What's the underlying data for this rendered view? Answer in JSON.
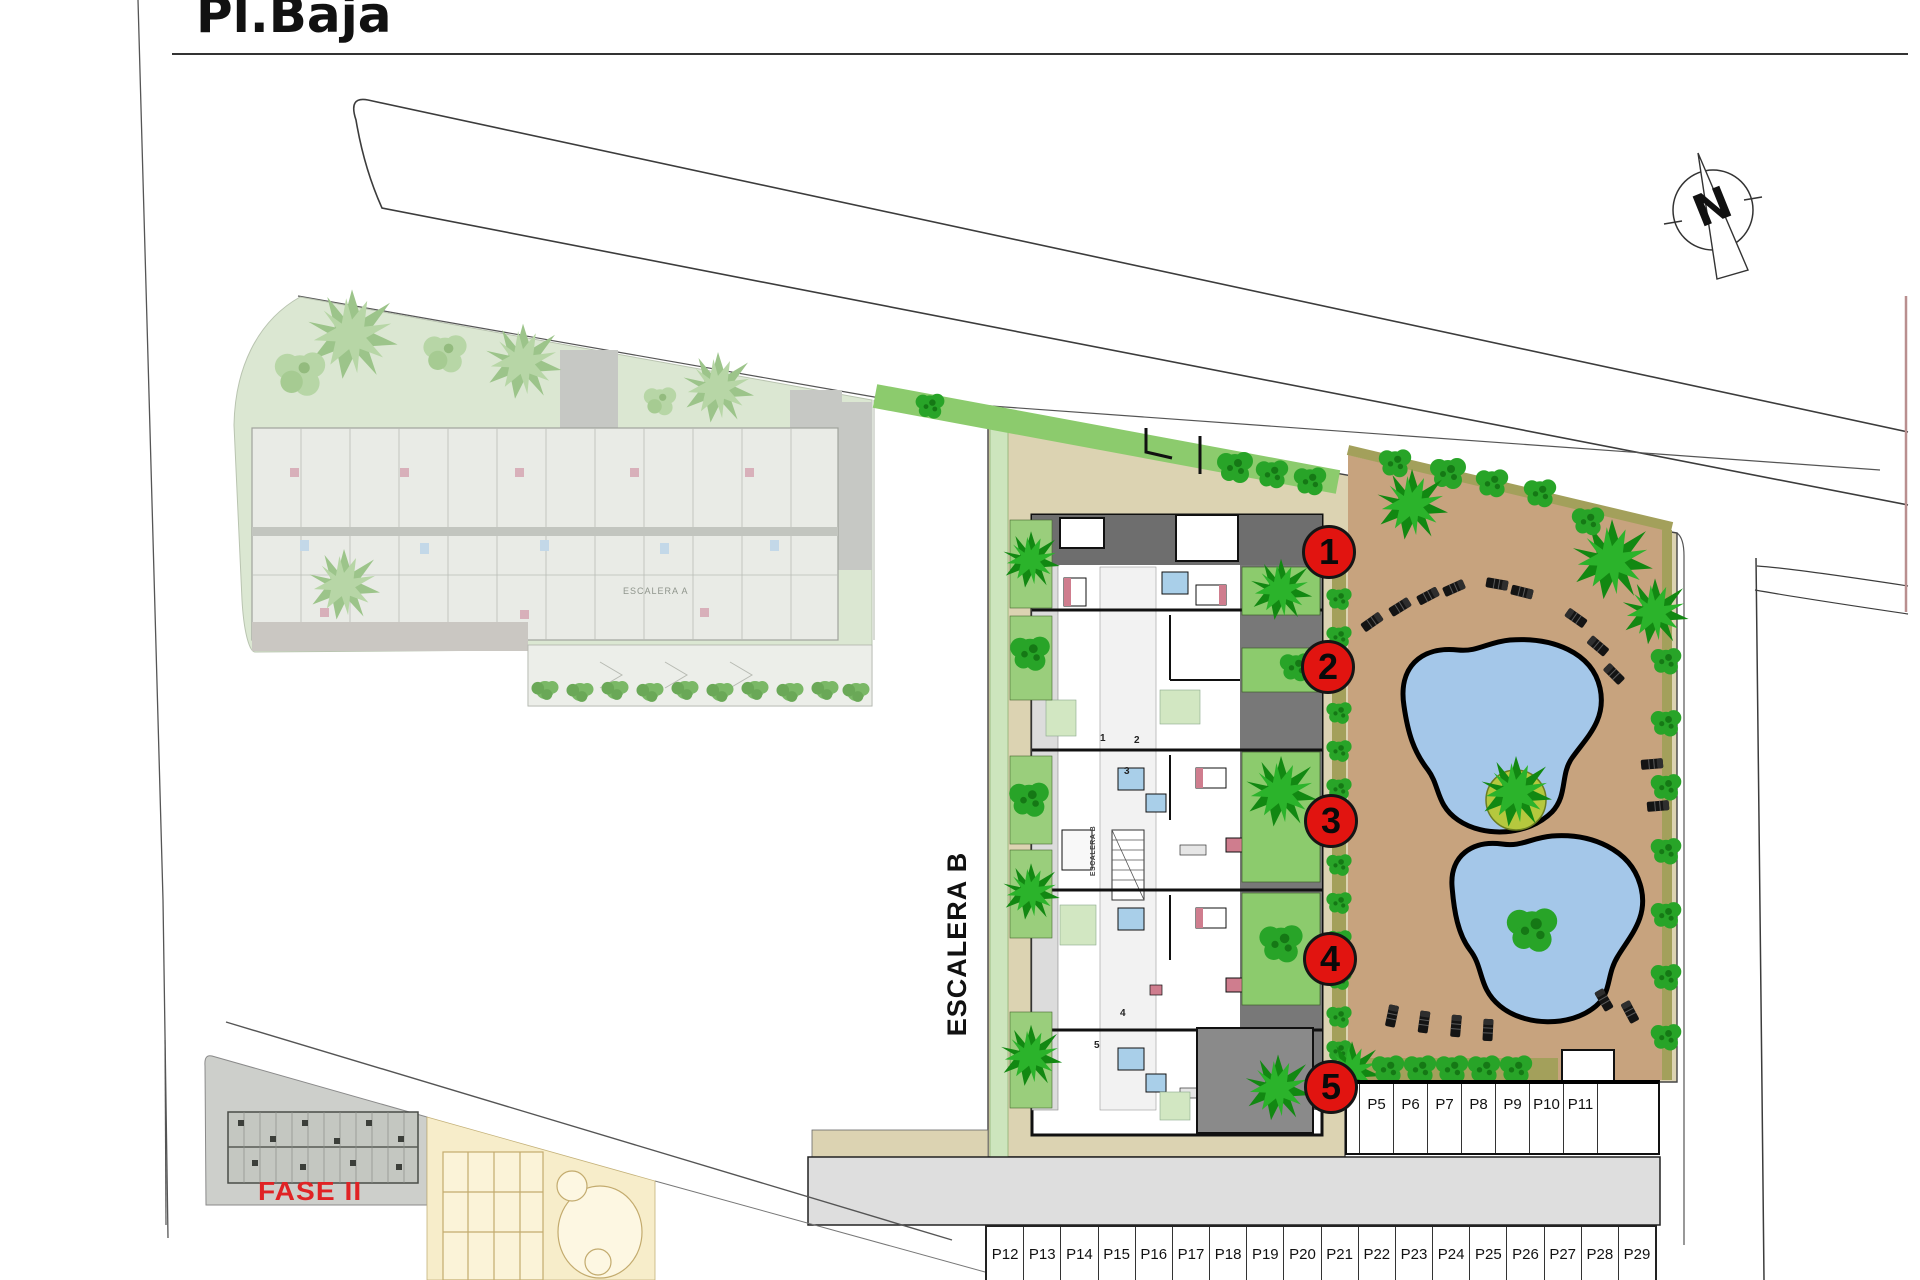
{
  "page": {
    "title": "Pl.Baja"
  },
  "compass": {
    "label": "N"
  },
  "plan": {
    "stair_b_label": "ESCALERA B",
    "stair_b_inner_label": "ESCALERA B",
    "stair_a_label": "ESCALERA A",
    "phase_label": "FASE II",
    "unit_markers": [
      "1",
      "2",
      "3",
      "4",
      "5"
    ],
    "unit_plan_numbers": [
      "1",
      "2",
      "3",
      "4",
      "5"
    ]
  },
  "parking": {
    "upper_row": [
      "P5",
      "P6",
      "P7",
      "P8",
      "P9",
      "P10",
      "P11"
    ],
    "lower_row": [
      "P12",
      "P13",
      "P14",
      "P15",
      "P16",
      "P17",
      "P18",
      "P19",
      "P20",
      "P21",
      "P22",
      "P23",
      "P24",
      "P25",
      "P26",
      "P27",
      "P28",
      "P29"
    ]
  },
  "colors": {
    "marker_red": "#e11410",
    "phase_red": "#e02325",
    "pool_blue": "#a4c7e9",
    "deck_brown": "#c7a37e",
    "path_tan": "#dcd3b2",
    "garden_green": "#8ccb6d",
    "tree_green": "#1ea51e",
    "hedge_olive": "#a3a05b",
    "faded_site_green": "#dbe7d2",
    "road_gray": "#dedede",
    "cream_parcel": "#f7edca"
  }
}
